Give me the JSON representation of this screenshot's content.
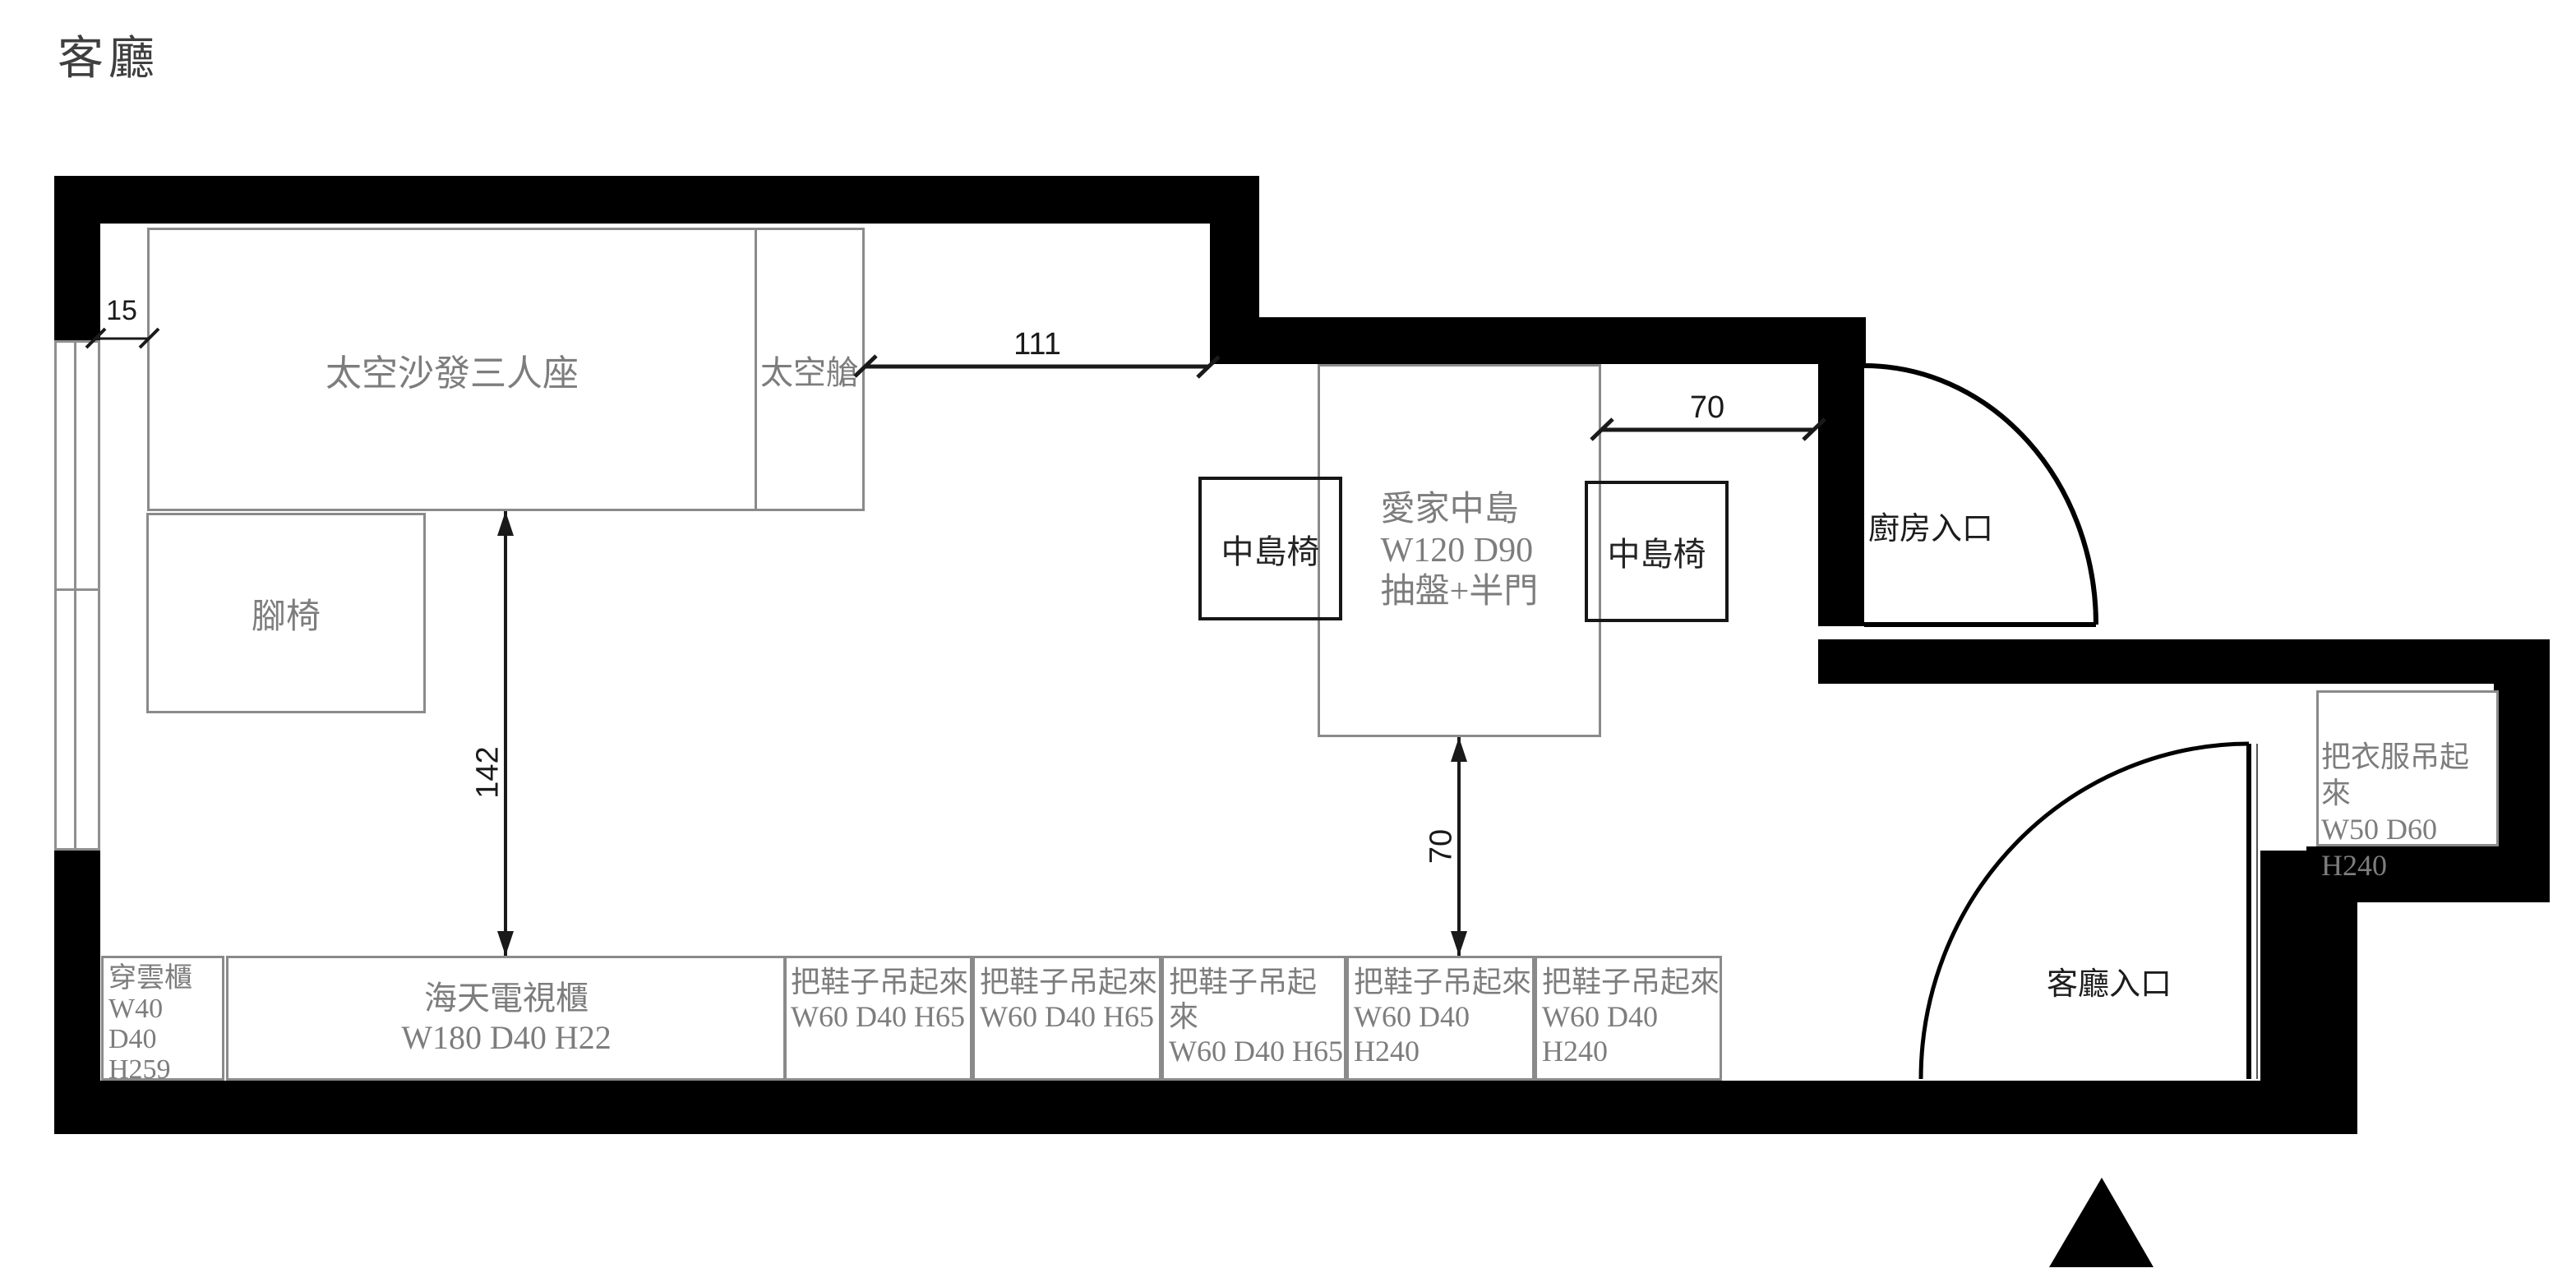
{
  "title": "客廳",
  "colors": {
    "wall": "#000000",
    "furniture_border": "#8a8a8a",
    "chair_border": "#161616",
    "label_gray": "#7d7d7d",
    "dim_color": "#1a1a1a"
  },
  "furniture": {
    "sofa": {
      "label": "太空沙發三人座"
    },
    "capsule": {
      "label": "太空艙"
    },
    "footstool": {
      "label": "腳椅"
    },
    "island": {
      "name": "愛家中島",
      "size": "W120 D90",
      "feature": "抽盤+半門"
    },
    "chair_left": {
      "label": "中島椅"
    },
    "chair_right": {
      "label": "中島椅"
    },
    "wardrobe": {
      "name": "把衣服吊起來",
      "size": "W50 D60 H240"
    },
    "cloud_cabinet": {
      "name": "穿雲櫃",
      "w": "W40",
      "d": "D40",
      "h": "H259"
    },
    "tv_cabinet": {
      "name": "海天電視櫃",
      "size": "W180 D40 H22"
    },
    "shoe_cabinets": [
      {
        "name": "把鞋子吊起來",
        "size": "W60 D40 H65"
      },
      {
        "name": "把鞋子吊起來",
        "size": "W60 D40 H65"
      },
      {
        "name": "把鞋子吊起來",
        "size": "W60 D40 H65"
      },
      {
        "name": "把鞋子吊起來",
        "size": "W60 D40 H240"
      },
      {
        "name": "把鞋子吊起來",
        "size": "W60 D40 H240"
      }
    ]
  },
  "entrances": {
    "kitchen": "廚房入口",
    "living": "客廳入口"
  },
  "dimensions": {
    "wall_gap": "15",
    "sofa_to_island": "111",
    "island_to_wall": "70",
    "island_to_shoes": "70",
    "sofa_to_tv": "142"
  }
}
